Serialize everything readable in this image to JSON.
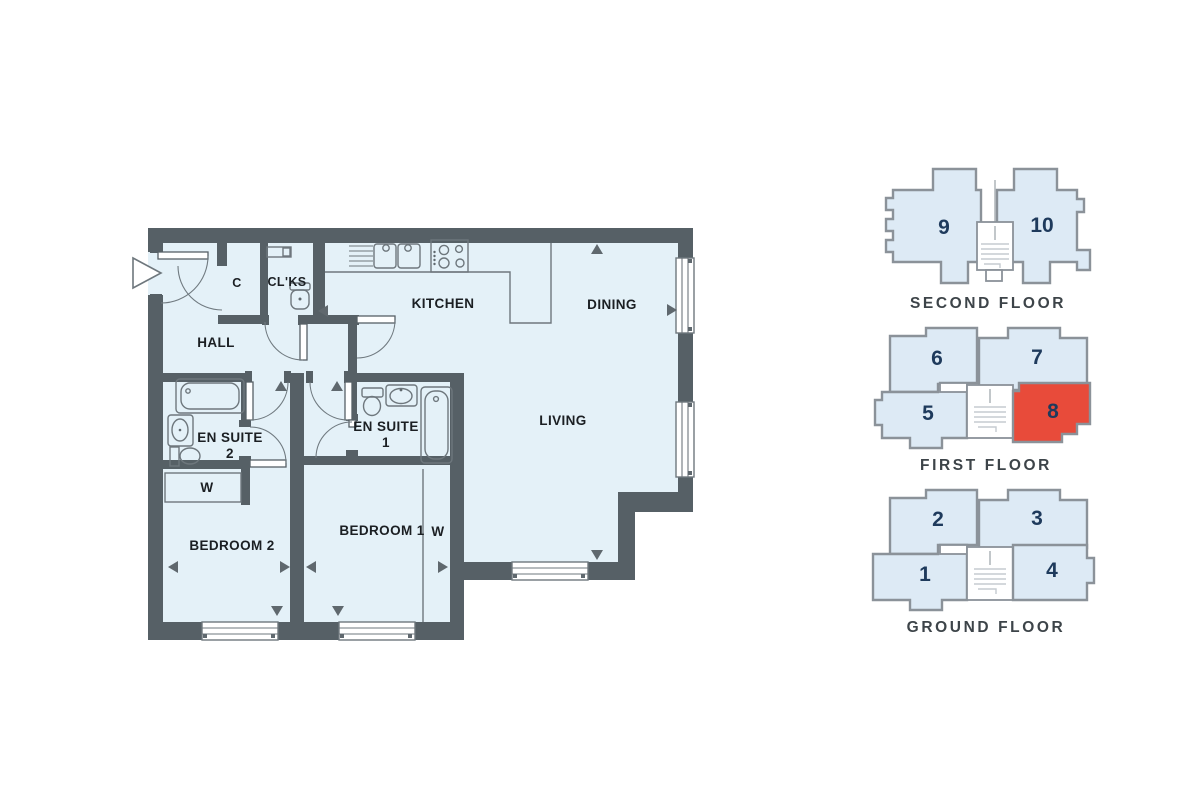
{
  "floorplan": {
    "labels": {
      "c": "C",
      "clks": "CL'KS",
      "hall": "HALL",
      "kitchen": "KITCHEN",
      "dining": "DINING",
      "living": "LIVING",
      "ensuite1_name": "EN SUITE",
      "ensuite1_num": "1",
      "ensuite2_name": "EN SUITE",
      "ensuite2_num": "2",
      "bedroom1": "BEDROOM 1",
      "bedroom2": "BEDROOM 2",
      "wardrobe_bedroom1": "W",
      "wardrobe_bedroom2": "W"
    }
  },
  "keyplan": {
    "highlighted_unit": "8",
    "floors": [
      {
        "label": "SECOND FLOOR",
        "units": [
          {
            "number": "9",
            "highlighted": false
          },
          {
            "number": "10",
            "highlighted": false
          }
        ]
      },
      {
        "label": "FIRST FLOOR",
        "units": [
          {
            "number": "6",
            "highlighted": false
          },
          {
            "number": "7",
            "highlighted": false
          },
          {
            "number": "5",
            "highlighted": false
          },
          {
            "number": "8",
            "highlighted": true
          }
        ]
      },
      {
        "label": "GROUND FLOOR",
        "units": [
          {
            "number": "2",
            "highlighted": false
          },
          {
            "number": "3",
            "highlighted": false
          },
          {
            "number": "1",
            "highlighted": false
          },
          {
            "number": "4",
            "highlighted": false
          }
        ]
      }
    ]
  },
  "colors": {
    "room_fill": "#e4f1f8",
    "wall": "#566066",
    "fixture_line": "#6e777d",
    "highlight": "#e84b3a",
    "keyplan_unit_fill": "#ddeaf5",
    "keyplan_unit_stroke": "#8b9299",
    "unit_number": "#1e3a5c",
    "floor_label": "#3d4449",
    "plan_label": "#1b1f23"
  }
}
